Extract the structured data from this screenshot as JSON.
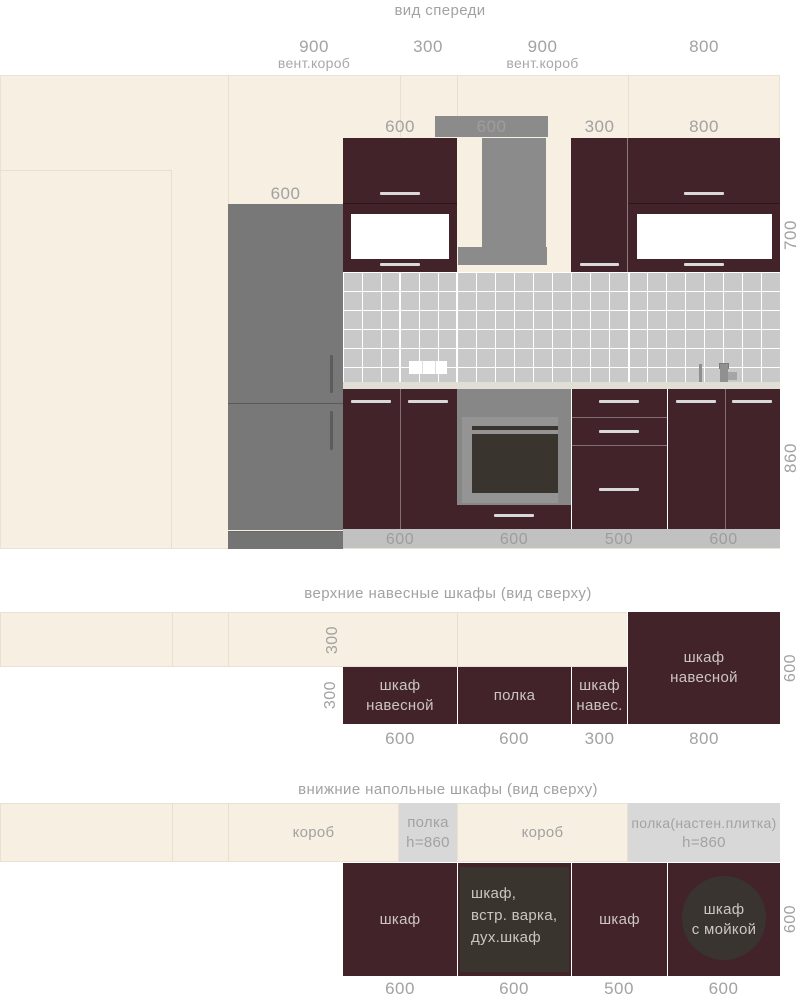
{
  "front": {
    "title": "вид спереди",
    "dim_900a": "900",
    "dim_900a_note": "вент.короб",
    "dim_300": "300",
    "dim_900b": "900",
    "dim_900b_note": "вент.короб",
    "dim_800": "800",
    "cab_600": "600",
    "vent_600": "600",
    "cab_300": "300",
    "cab_800": "800",
    "fridge_600": "600",
    "height_700": "700",
    "height_860": "860",
    "plinth_1": "600",
    "plinth_2": "600",
    "plinth_3": "500",
    "plinth_4": "600"
  },
  "upper": {
    "title": "верхние навесные шкафы (вид сверху)",
    "wall_depth": "300",
    "row_depth": "300",
    "right_depth": "600",
    "cab1_line1": "шкаф",
    "cab1_line2": "навесной",
    "cab2": "полка",
    "cab3_line1": "шкаф",
    "cab3_line2": "навес.",
    "cab4_line1": "шкаф",
    "cab4_line2": "навесной",
    "dim_1": "600",
    "dim_2": "600",
    "dim_3": "300",
    "dim_4": "800"
  },
  "lower": {
    "title": "внижние напольные шкафы (вид сверху)",
    "korob_1": "короб",
    "shelf1_line1": "полка",
    "shelf1_line2": "h=860",
    "korob_2": "короб",
    "shelf2_line1": "полка(настен.плитка)",
    "shelf2_line2": "h=860",
    "cab1": "шкаф",
    "cab2_line1": "шкаф,",
    "cab2_line2": "встр. варка,",
    "cab2_line3": "дух.шкаф",
    "cab3": "шкаф",
    "cab4_line1": "шкаф",
    "cab4_line2": "с мойкой",
    "right_depth": "600",
    "dim_1": "600",
    "dim_2": "600",
    "dim_3": "500",
    "dim_4": "600"
  },
  "colors": {
    "wall_cream": "#f6efe2",
    "cabinet_maroon": "#412329",
    "appliance_gray": "#8b8b8b",
    "tile_gray": "#c9c9c9",
    "label_gray": "#a2a2a2",
    "dark_panel": "#3a342e"
  }
}
